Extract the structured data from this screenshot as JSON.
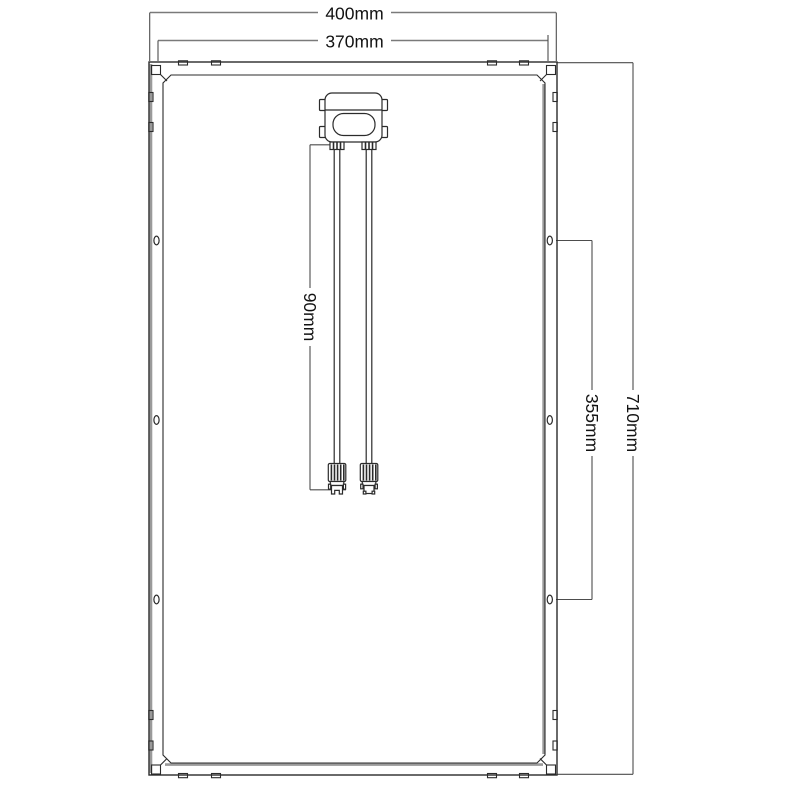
{
  "diagram": {
    "labels": {
      "outer_width": "400mm",
      "inner_width": "370mm",
      "overall_height": "710mm",
      "hole_spacing": "355mm",
      "cable_length": "90mm"
    },
    "colors": {
      "background": "#ffffff",
      "frame_line": "#2b2b2b",
      "frame_accent": "#9a9a9a",
      "dimension_line": "#4d4d4d",
      "text": "#121212"
    }
  }
}
